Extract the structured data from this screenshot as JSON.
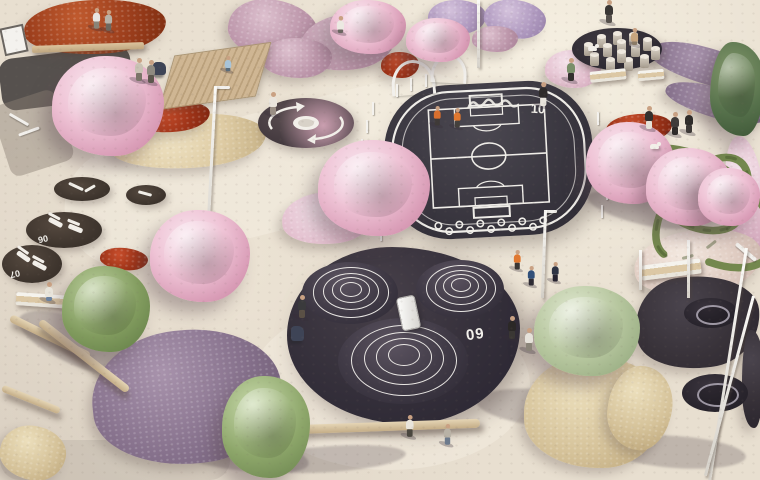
{
  "palette": {
    "paving": "#e8dfd0",
    "asphalt_court": "#3a3740",
    "rubber_play": "#342f3a",
    "white_line": "#efede8",
    "rust_bed": "#9c3e1c",
    "pink_bloom": "#efc4d6",
    "purple_bed": "#86718c",
    "green_tree": "#819b5e",
    "dry_grass": "#d5c299",
    "wood": "#c4ad87"
  },
  "court": {
    "number": "10"
  },
  "mounds": {
    "number": "09",
    "list": [
      {
        "x": 302,
        "y": 262,
        "w": 96,
        "h": 62,
        "rings": [
          0.78,
          0.57,
          0.38,
          0.21
        ]
      },
      {
        "x": 416,
        "y": 260,
        "w": 88,
        "h": 58,
        "rings": [
          0.78,
          0.57,
          0.38,
          0.21
        ]
      },
      {
        "x": 338,
        "y": 318,
        "w": 130,
        "h": 86,
        "rings": [
          0.8,
          0.6,
          0.41,
          0.23
        ]
      }
    ],
    "num_x": 466,
    "num_y": 326
  },
  "lounges": [
    {
      "x": 54,
      "y": 177,
      "w": 56,
      "h": 24,
      "label": "",
      "chairs": [],
      "items": [
        {
          "dx": 14,
          "dy": 8,
          "w": 16,
          "h": 3,
          "r": 25
        },
        {
          "dx": 30,
          "dy": 10,
          "w": 12,
          "h": 3,
          "r": -30
        }
      ]
    },
    {
      "x": 126,
      "y": 185,
      "w": 40,
      "h": 20,
      "label": "",
      "chairs": [],
      "items": [
        {
          "dx": 12,
          "dy": 7,
          "w": 14,
          "h": 3,
          "r": 15
        }
      ]
    },
    {
      "x": 26,
      "y": 212,
      "w": 76,
      "h": 36,
      "label": "06",
      "lx": 12,
      "ly": 22,
      "chairs": [
        {
          "dx": 22,
          "dy": 8,
          "r": 28
        },
        {
          "dx": 42,
          "dy": 14,
          "r": 22
        }
      ],
      "items": []
    },
    {
      "x": 2,
      "y": 245,
      "w": 60,
      "h": 38,
      "label": "07",
      "lx": 8,
      "ly": 24,
      "chairs": [
        {
          "dx": 14,
          "dy": 9,
          "r": 35
        },
        {
          "dx": 30,
          "dy": 18,
          "r": 28
        }
      ],
      "items": []
    }
  ],
  "beds": [
    {
      "x": 24,
      "y": 0,
      "w": 142,
      "h": 54,
      "t": "rust",
      "r": -3
    },
    {
      "x": 110,
      "y": 114,
      "w": 156,
      "h": 54,
      "t": "cream",
      "r": -4
    },
    {
      "x": 136,
      "y": 102,
      "w": 74,
      "h": 30,
      "t": "red",
      "r": -6
    },
    {
      "x": 100,
      "y": 248,
      "w": 48,
      "h": 22,
      "t": "red",
      "r": 5
    },
    {
      "x": 381,
      "y": 52,
      "w": 38,
      "h": 26,
      "t": "red",
      "r": 0
    },
    {
      "x": 606,
      "y": 114,
      "w": 66,
      "h": 28,
      "t": "red",
      "r": -4
    },
    {
      "x": 228,
      "y": 0,
      "w": 90,
      "h": 60,
      "t": "mauve",
      "r": 10
    },
    {
      "x": 300,
      "y": 14,
      "w": 96,
      "h": 56,
      "t": "mauve",
      "r": -8
    },
    {
      "x": 262,
      "y": 38,
      "w": 70,
      "h": 40,
      "t": "mauve",
      "r": 0
    },
    {
      "x": 428,
      "y": 0,
      "w": 58,
      "h": 34,
      "t": "lavender",
      "r": 0
    },
    {
      "x": 484,
      "y": 0,
      "w": 62,
      "h": 38,
      "t": "lavender",
      "r": 8
    },
    {
      "x": 472,
      "y": 26,
      "w": 46,
      "h": 26,
      "t": "mauve",
      "r": 0
    },
    {
      "x": 545,
      "y": 50,
      "w": 56,
      "h": 38,
      "t": "palepink",
      "r": 0
    },
    {
      "x": 586,
      "y": 38,
      "w": 52,
      "h": 30,
      "t": "palepink",
      "r": 6
    },
    {
      "x": 648,
      "y": 48,
      "w": 118,
      "h": 36,
      "t": "purple",
      "r": 16
    },
    {
      "x": 664,
      "y": 88,
      "w": 106,
      "h": 30,
      "t": "purple",
      "r": 16
    },
    {
      "x": 726,
      "y": 136,
      "w": 38,
      "h": 118,
      "t": "palepink",
      "r": -6
    },
    {
      "x": 634,
      "y": 230,
      "w": 128,
      "h": 64,
      "t": "pampas",
      "r": -8
    },
    {
      "x": 282,
      "y": 192,
      "w": 92,
      "h": 52,
      "t": "palepink",
      "r": -5
    },
    {
      "x": 92,
      "y": 330,
      "w": 190,
      "h": 134,
      "t": "purple",
      "r": -6
    },
    {
      "x": 524,
      "y": 356,
      "w": 140,
      "h": 112,
      "t": "grass",
      "r": 0
    },
    {
      "x": 608,
      "y": 366,
      "w": 64,
      "h": 84,
      "t": "grass",
      "r": 8
    },
    {
      "x": 0,
      "y": 426,
      "w": 66,
      "h": 54,
      "t": "grass",
      "r": 10
    },
    {
      "x": 636,
      "y": 276,
      "w": 124,
      "h": 92,
      "t": "rubber",
      "r": -6
    },
    {
      "x": 742,
      "y": 330,
      "w": 22,
      "h": 98,
      "t": "rubber",
      "r": 0
    }
  ],
  "trees": [
    {
      "x": 52,
      "y": 56,
      "w": 112,
      "h": 100,
      "t": "pink"
    },
    {
      "x": 150,
      "y": 210,
      "w": 100,
      "h": 92,
      "t": "pink"
    },
    {
      "x": 318,
      "y": 140,
      "w": 112,
      "h": 96,
      "t": "pink"
    },
    {
      "x": 330,
      "y": 0,
      "w": 76,
      "h": 54,
      "t": "pink"
    },
    {
      "x": 406,
      "y": 18,
      "w": 64,
      "h": 44,
      "t": "pink"
    },
    {
      "x": 586,
      "y": 122,
      "w": 88,
      "h": 82,
      "t": "pink"
    },
    {
      "x": 646,
      "y": 148,
      "w": 86,
      "h": 78,
      "t": "pink"
    },
    {
      "x": 698,
      "y": 168,
      "w": 62,
      "h": 58,
      "t": "pink"
    },
    {
      "x": 62,
      "y": 266,
      "w": 88,
      "h": 86,
      "t": "green"
    },
    {
      "x": 222,
      "y": 376,
      "w": 88,
      "h": 102,
      "t": "green2"
    },
    {
      "x": 534,
      "y": 286,
      "w": 106,
      "h": 90,
      "t": "olive"
    },
    {
      "x": 710,
      "y": 42,
      "w": 54,
      "h": 94,
      "t": "conifer"
    }
  ],
  "shadows": [
    {
      "x": 14,
      "y": 322,
      "w": 142,
      "h": 46,
      "r": 22
    },
    {
      "x": 138,
      "y": 430,
      "w": 172,
      "h": 38,
      "r": 10
    },
    {
      "x": 476,
      "y": 390,
      "w": 152,
      "h": 38,
      "r": 6
    },
    {
      "x": 606,
      "y": 436,
      "w": 140,
      "h": 32,
      "r": 4
    },
    {
      "x": 256,
      "y": 446,
      "w": 150,
      "h": 26,
      "r": -4
    },
    {
      "x": 586,
      "y": 196,
      "w": 110,
      "h": 28,
      "r": 14
    }
  ],
  "paths": [
    {
      "x": 0,
      "y": 52,
      "w": 132,
      "h": 52,
      "c": "#56514e",
      "r": -7,
      "rad": "14px"
    },
    {
      "x": 0,
      "y": 96,
      "w": 66,
      "h": 74,
      "c": "rgba(140,128,118,.45)",
      "r": -18,
      "rad": "10px"
    },
    {
      "x": 60,
      "y": 110,
      "w": 430,
      "h": 120,
      "c": "rgba(248,242,230,.40)",
      "r": -14,
      "rad": "60px"
    },
    {
      "x": 250,
      "y": 300,
      "w": 280,
      "h": 170,
      "c": "rgba(248,243,232,.35)",
      "r": 0,
      "rad": "50%"
    },
    {
      "x": 0,
      "y": 440,
      "w": 230,
      "h": 40,
      "c": "rgba(120,110,105,.14)",
      "r": 0,
      "rad": "20px"
    }
  ],
  "furniture": [
    {
      "t": "sign",
      "x": 2,
      "y": 26,
      "w": 20,
      "h": 24,
      "r": -12
    },
    {
      "t": "deck",
      "x": 166,
      "y": 50,
      "w": 96,
      "h": 50,
      "r": -8,
      "skew": -24
    },
    {
      "t": "bench-wood",
      "x": 32,
      "y": 44,
      "w": 112,
      "h": 7,
      "r": -2
    },
    {
      "t": "bench-white",
      "x": 590,
      "y": 70,
      "w": 36,
      "h": 11,
      "r": -6
    },
    {
      "t": "bench-white",
      "x": 638,
      "y": 70,
      "w": 26,
      "h": 10,
      "r": -5
    },
    {
      "t": "bench-white",
      "x": 641,
      "y": 262,
      "w": 60,
      "h": 15,
      "r": -7
    },
    {
      "t": "bench-white",
      "x": 16,
      "y": 294,
      "w": 56,
      "h": 13,
      "r": 4
    },
    {
      "t": "log",
      "x": 290,
      "y": 422,
      "w": 190,
      "h": 9,
      "r": -2
    },
    {
      "t": "log",
      "x": 6,
      "y": 333,
      "w": 88,
      "h": 8,
      "r": 26
    },
    {
      "t": "log",
      "x": 28,
      "y": 352,
      "w": 112,
      "h": 8,
      "r": 38
    },
    {
      "t": "log",
      "x": 0,
      "y": 396,
      "w": 62,
      "h": 7,
      "r": 22
    },
    {
      "t": "arch",
      "x": 391,
      "y": 60,
      "w": 38,
      "h": 32,
      "r": -4
    },
    {
      "t": "arch",
      "x": 431,
      "y": 54,
      "w": 30,
      "h": 26,
      "r": 3
    },
    {
      "t": "slide",
      "x": 399,
      "y": 296,
      "w": 17,
      "h": 32,
      "r": -12
    },
    {
      "t": "rail",
      "x": 216,
      "y": 86,
      "w": 14,
      "h": 3,
      "r": 0
    },
    {
      "t": "rail",
      "x": 545,
      "y": 210,
      "w": 12,
      "h": 3,
      "r": 0
    },
    {
      "t": "rail",
      "x": 8,
      "y": 118,
      "w": 22,
      "h": 3,
      "r": 30
    },
    {
      "t": "rail",
      "x": 18,
      "y": 130,
      "w": 22,
      "h": 3,
      "r": -20
    },
    {
      "t": "rail",
      "x": 733,
      "y": 250,
      "w": 26,
      "h": 4,
      "r": 40
    },
    {
      "t": "stroller",
      "x": 153,
      "y": 62,
      "w": 13,
      "h": 13,
      "r": 0
    },
    {
      "t": "stroller",
      "x": 291,
      "y": 326,
      "w": 13,
      "h": 15,
      "r": 0
    },
    {
      "t": "swing-pad",
      "x": 684,
      "y": 298,
      "w": 54,
      "h": 30,
      "r": 0
    },
    {
      "t": "swing-ring",
      "x": 696,
      "y": 305,
      "w": 30,
      "h": 16,
      "r": 0
    },
    {
      "t": "swing-pad",
      "x": 682,
      "y": 374,
      "w": 66,
      "h": 38,
      "r": 0
    },
    {
      "t": "swing-ring",
      "x": 697,
      "y": 383,
      "w": 38,
      "h": 20,
      "r": 0
    }
  ],
  "poles": [
    {
      "x": 214,
      "y": 86,
      "h": 165,
      "r": 3
    },
    {
      "x": 477,
      "y": 0,
      "h": 68,
      "r": 0
    },
    {
      "x": 544,
      "y": 210,
      "h": 88,
      "r": 2
    },
    {
      "x": 687,
      "y": 240,
      "h": 58,
      "r": 0
    },
    {
      "x": 745,
      "y": 248,
      "h": 235,
      "r": 9
    },
    {
      "x": 752,
      "y": 296,
      "h": 186,
      "r": 15
    },
    {
      "x": 639,
      "y": 250,
      "h": 40,
      "r": 0
    }
  ],
  "fences": [
    [
      372,
      102
    ],
    [
      366,
      120
    ],
    [
      361,
      139
    ],
    [
      359,
      158
    ],
    [
      360,
      177
    ],
    [
      364,
      196
    ],
    [
      371,
      213
    ],
    [
      380,
      228
    ],
    [
      597,
      112
    ],
    [
      603,
      130
    ],
    [
      607,
      149
    ],
    [
      608,
      168
    ],
    [
      606,
      187
    ],
    [
      601,
      205
    ],
    [
      396,
      84
    ],
    [
      410,
      78
    ],
    [
      425,
      74
    ]
  ],
  "people": [
    {
      "x": 92,
      "y": 8,
      "s": 0.9,
      "shirt": "#e8e6e2",
      "pants": "#8a8478"
    },
    {
      "x": 104,
      "y": 10,
      "s": 0.9,
      "shirt": "#b8b2a8",
      "pants": "#6d675e"
    },
    {
      "x": 134,
      "y": 58,
      "s": 1,
      "shirt": "#c9c2b4",
      "pants": "#7a7468"
    },
    {
      "x": 146,
      "y": 60,
      "s": 1,
      "shirt": "#8f8a80",
      "pants": "#5d574e"
    },
    {
      "x": 224,
      "y": 56,
      "s": 0.8,
      "sit": true,
      "shirt": "#a8c4d8",
      "pants": "#5a6c7a"
    },
    {
      "x": 268,
      "y": 92,
      "s": 1,
      "shirt": "#e9e4dc",
      "pants": "#9a8f85"
    },
    {
      "x": 336,
      "y": 16,
      "s": 0.9,
      "sit": true,
      "shirt": "#ece9e2",
      "pants": "#6b6560"
    },
    {
      "x": 433,
      "y": 106,
      "s": 0.85,
      "shirt": "#d96f2e",
      "pants": "#3f3a38"
    },
    {
      "x": 453,
      "y": 108,
      "s": 0.85,
      "shirt": "#e07830",
      "pants": "#44403c"
    },
    {
      "x": 538,
      "y": 82,
      "s": 1.05,
      "shirt": "#2e2b2a",
      "pants": "#e8e4dc"
    },
    {
      "x": 566,
      "y": 58,
      "s": 1,
      "shirt": "#7a8f6a",
      "pants": "#33302e"
    },
    {
      "x": 604,
      "y": 0,
      "s": 1,
      "shirt": "#3a3735",
      "pants": "#55504c"
    },
    {
      "x": 630,
      "y": 28,
      "s": 0.9,
      "sit": true,
      "shirt": "#c8a57e",
      "pants": "#8a7a66"
    },
    {
      "x": 670,
      "y": 112,
      "s": 1,
      "shirt": "#403c3a",
      "pants": "#2e2b29"
    },
    {
      "x": 684,
      "y": 110,
      "s": 1,
      "shirt": "#2f2c2a",
      "pants": "#3c3836"
    },
    {
      "x": 644,
      "y": 106,
      "s": 1,
      "shirt": "#33302e",
      "pants": "#e5e1d8"
    },
    {
      "x": 513,
      "y": 250,
      "s": 0.85,
      "shirt": "#e07830",
      "pants": "#3a3634"
    },
    {
      "x": 527,
      "y": 266,
      "s": 0.85,
      "shirt": "#31507a",
      "pants": "#2e2b33"
    },
    {
      "x": 551,
      "y": 262,
      "s": 0.85,
      "shirt": "#2e3444",
      "pants": "#262330"
    },
    {
      "x": 507,
      "y": 316,
      "s": 1,
      "shirt": "#2b2826",
      "pants": "#3a3734"
    },
    {
      "x": 524,
      "y": 328,
      "s": 1,
      "shirt": "#e6e2da",
      "pants": "#8a8478"
    },
    {
      "x": 297,
      "y": 295,
      "s": 1,
      "shirt": "#3a3a3c",
      "pants": "#5a5045"
    },
    {
      "x": 44,
      "y": 282,
      "s": 1,
      "sit": true,
      "shirt": "#e8e4da",
      "pants": "#6b82a0"
    },
    {
      "x": 405,
      "y": 415,
      "s": 0.95,
      "shirt": "#e9e5dc",
      "pants": "#4a463f"
    },
    {
      "x": 443,
      "y": 424,
      "s": 0.9,
      "shirt": "#b9b2a6",
      "pants": "#6d7a8c"
    }
  ],
  "dogs": [
    {
      "x": 650,
      "y": 144
    },
    {
      "x": 588,
      "y": 46
    }
  ],
  "stumps": [
    [
      12,
      16
    ],
    [
      25,
      8
    ],
    [
      41,
      5
    ],
    [
      57,
      6
    ],
    [
      71,
      11
    ],
    [
      79,
      20
    ],
    [
      68,
      28
    ],
    [
      52,
      31
    ],
    [
      34,
      31
    ],
    [
      18,
      26
    ],
    [
      31,
      17
    ],
    [
      45,
      13
    ],
    [
      59,
      17
    ],
    [
      45,
      23
    ]
  ]
}
